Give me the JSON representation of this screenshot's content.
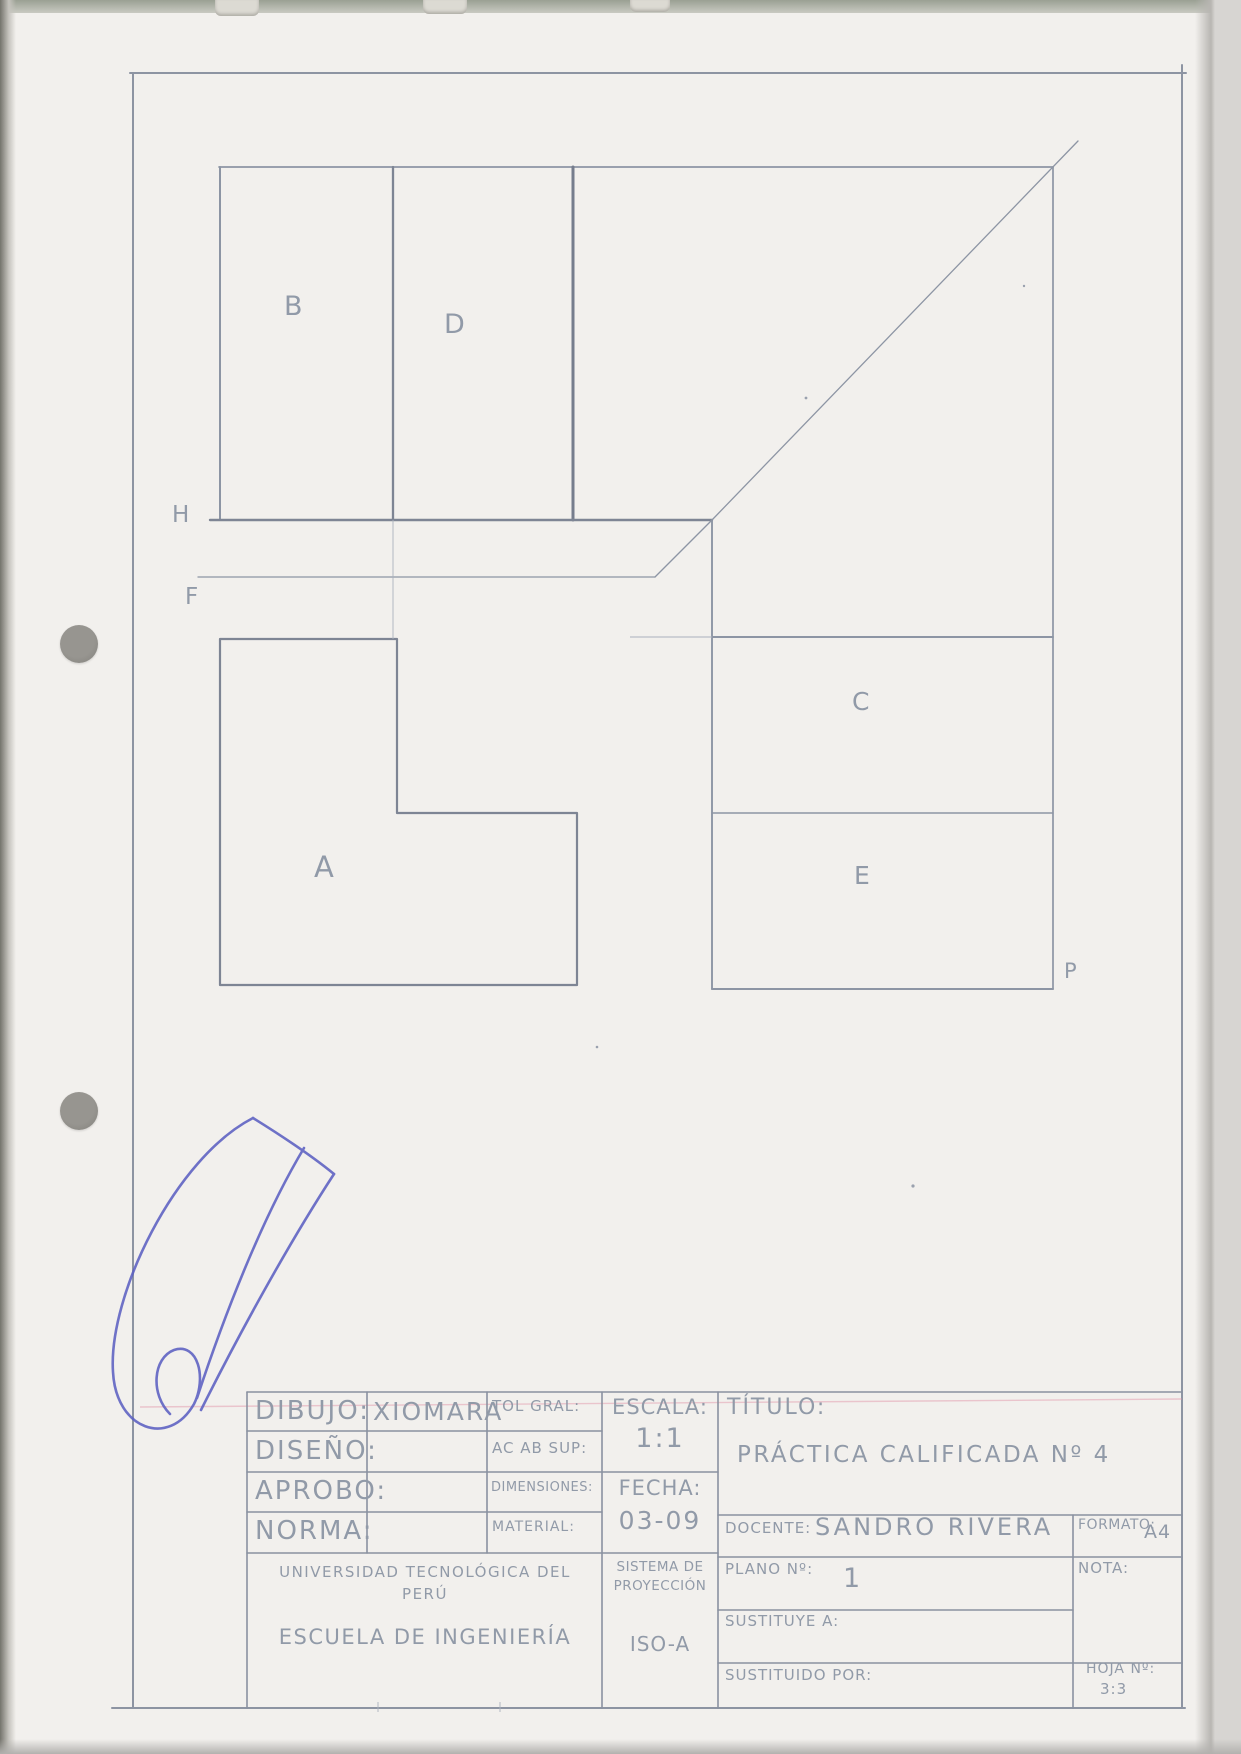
{
  "colors": {
    "pencil": "#8d95a4",
    "pencil_dark": "#7a8292",
    "ink_blue": "#5c60c2",
    "paper": "#f2f0ed",
    "red_margin_line": "#e08ea4"
  },
  "drawing": {
    "view_labels": {
      "B": "B",
      "D": "D",
      "A": "A",
      "C": "C",
      "E": "E"
    },
    "plane_labels": {
      "H": "H",
      "F": "F",
      "P": "P"
    }
  },
  "title_block": {
    "rows": [
      {
        "label": "DIBUJO:",
        "value": "XIOMARA"
      },
      {
        "label": "DISEÑO:",
        "value": ""
      },
      {
        "label": "APROBO:",
        "value": ""
      },
      {
        "label": "NORMA:",
        "value": ""
      }
    ],
    "specs": {
      "tol": "TOL GRAL:",
      "acab": "AC AB SUP:",
      "dim": "DIMENSIONES:",
      "mat": "MATERIAL:"
    },
    "escala": {
      "label": "ESCALA:",
      "value": "1:1"
    },
    "fecha": {
      "label": "FECHA:",
      "value": "03-09"
    },
    "titulo": {
      "label": "TÍTULO:",
      "value": "PRÁCTICA CALIFICADA Nº 4"
    },
    "docente": {
      "label": "DOCENTE:",
      "value": "SANDRO RIVERA"
    },
    "plano": {
      "label": "PLANO Nº:",
      "value": "1"
    },
    "sustituye": {
      "label": "SUSTITUYE A:",
      "value": ""
    },
    "sustituido": {
      "label": "SUSTITUIDO POR:",
      "value": ""
    },
    "formato": {
      "label": "FORMATO:",
      "value": "A4"
    },
    "nota": {
      "label": "NOTA:",
      "value": ""
    },
    "hoja": {
      "label": "HOJA Nº:",
      "value": "3:3"
    },
    "institucion": {
      "universidad": "UNIVERSIDAD TECNOLÓGICA DEL PERÚ",
      "escuela": "ESCUELA DE INGENIERÍA"
    },
    "proyeccion": {
      "label": "SISTEMA DE PROYECCIÓN",
      "value": "ISO-A"
    }
  }
}
